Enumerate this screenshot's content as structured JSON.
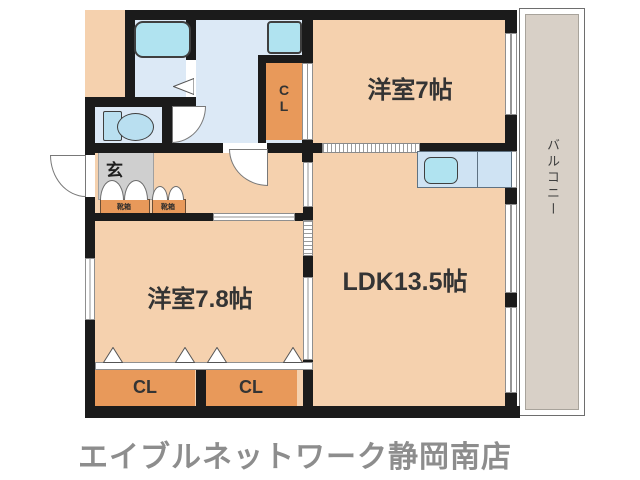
{
  "labels": {
    "bedroom1": "洋室7帖",
    "ldk": "LDK13.5帖",
    "bedroom2": "洋室7.8帖",
    "genkan": "玄",
    "closet_upper": "CL",
    "closet_bottom_left": "CL",
    "closet_bottom_right": "CL",
    "shoebox": "靴箱",
    "balcony": "バルコニー"
  },
  "footer": {
    "store_name": "エイブルネットワーク静岡南店"
  },
  "icons": [
    "bathtub-icon",
    "wash-basin-icon",
    "toilet-icon",
    "kitchen-sink-icon",
    "door-swing-arc",
    "folding-door-icon",
    "sliding-door",
    "window"
  ],
  "colors": {
    "room_floor": "#f5d1ae",
    "wet_area_floor": "#dce9f6",
    "closet_fill": "#e8995a",
    "fixture_fill": "#b0e3f0",
    "tataki_gray": "#cfcfcf",
    "balcony_floor": "#d8d0c7",
    "wall_black": "#1b1b1b",
    "caption_gray": "#8d8d8d"
  }
}
